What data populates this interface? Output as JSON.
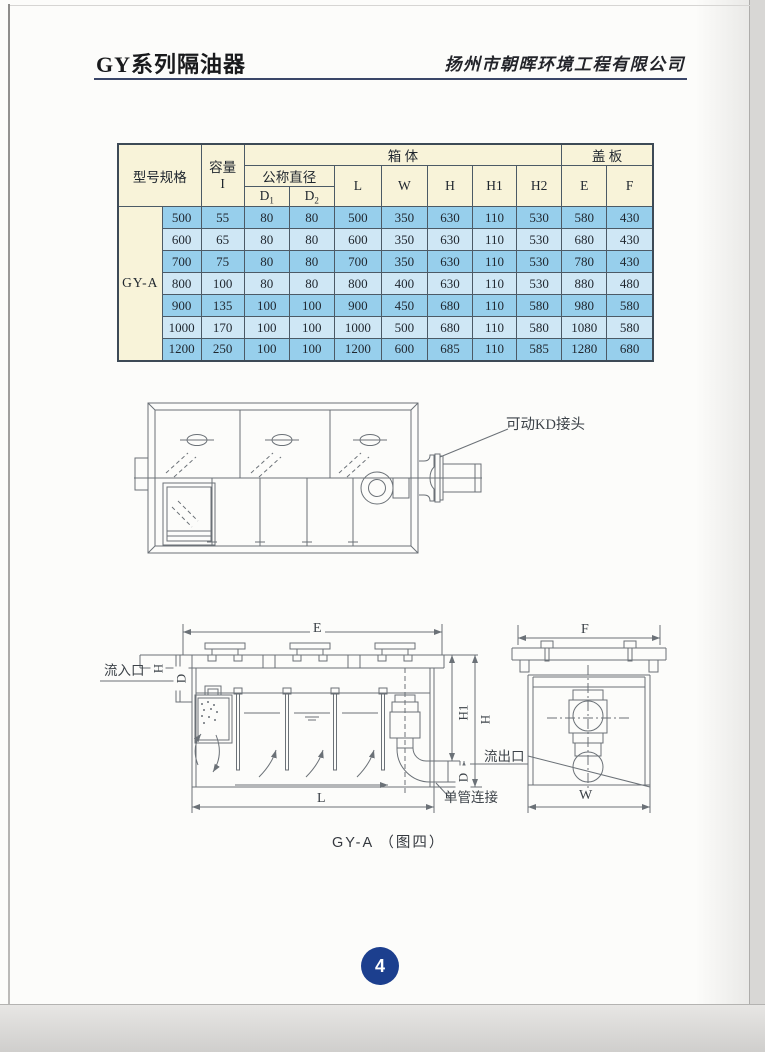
{
  "header": {
    "title": "GY系列隔油器",
    "company": "扬州市朝晖环境工程有限公司"
  },
  "table": {
    "headers": {
      "model": "型号规格",
      "capacity_l1": "容量",
      "capacity_l2": "I",
      "nominal_diameter": "公称直径",
      "d_base": "D",
      "d1_sub": "1",
      "d2_sub": "2",
      "box_body": "箱        体",
      "cover_plate": "盖   板",
      "dims": [
        "L",
        "W",
        "H",
        "H1",
        "H2"
      ],
      "cover_dims": [
        "E",
        "F"
      ]
    },
    "model_label": "GY-A",
    "rows": [
      [
        "500",
        "55",
        "80",
        "80",
        "500",
        "350",
        "630",
        "110",
        "530",
        "580",
        "430"
      ],
      [
        "600",
        "65",
        "80",
        "80",
        "600",
        "350",
        "630",
        "110",
        "530",
        "680",
        "430"
      ],
      [
        "700",
        "75",
        "80",
        "80",
        "700",
        "350",
        "630",
        "110",
        "530",
        "780",
        "430"
      ],
      [
        "800",
        "100",
        "80",
        "80",
        "800",
        "400",
        "630",
        "110",
        "530",
        "880",
        "480"
      ],
      [
        "900",
        "135",
        "100",
        "100",
        "900",
        "450",
        "680",
        "110",
        "580",
        "980",
        "580"
      ],
      [
        "1000",
        "170",
        "100",
        "100",
        "1000",
        "500",
        "680",
        "110",
        "580",
        "1080",
        "580"
      ],
      [
        "1200",
        "250",
        "100",
        "100",
        "1200",
        "600",
        "685",
        "110",
        "585",
        "1280",
        "680"
      ]
    ]
  },
  "diagram_top": {
    "kd_joint": "可动KD接头"
  },
  "diagram_bottom": {
    "e": "E",
    "f": "F",
    "l": "L",
    "w": "W",
    "h": "H",
    "h1": "H1",
    "d": "D",
    "inlet": "流入口",
    "outlet": "流出口",
    "single_pipe": "单管连接",
    "caption": "GY-A （图四）"
  },
  "footer": {
    "page_number": "4"
  },
  "colors": {
    "accent_blue": "#1c3f8e",
    "table_header_bg": "#f8f3d9",
    "table_row_dark": "#97cfec",
    "table_row_light": "#cfe7f5",
    "line_gray": "#6b7177",
    "header_rule": "#3a4668"
  }
}
